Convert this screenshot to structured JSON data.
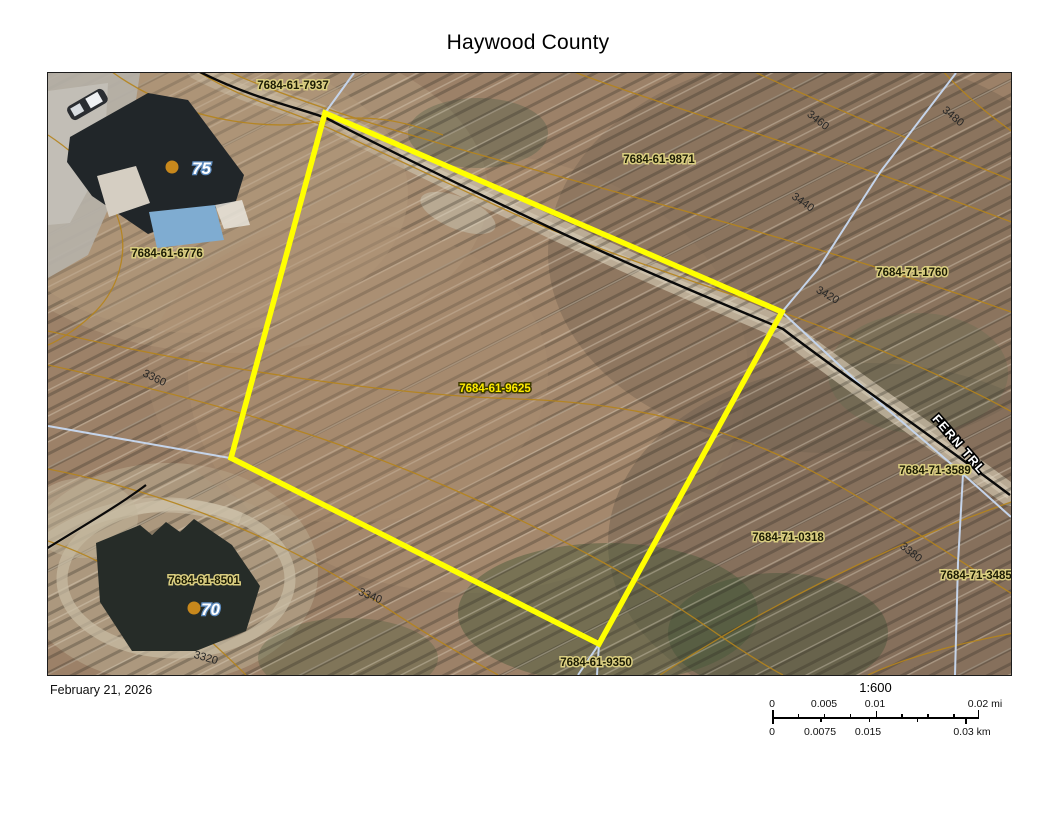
{
  "title": "Haywood County",
  "map": {
    "parcel_labels": [
      {
        "id": "7684-61-7937"
      },
      {
        "id": "7684-61-6776"
      },
      {
        "id": "7684-61-9871"
      },
      {
        "id": "7684-71-1760"
      },
      {
        "id": "7684-61-9625"
      },
      {
        "id": "7684-71-3589"
      },
      {
        "id": "7684-71-0318"
      },
      {
        "id": "7684-71-3485"
      },
      {
        "id": "7684-61-8501"
      },
      {
        "id": "7684-61-9350"
      }
    ],
    "selected_parcel": "7684-61-9625",
    "contour_labels": [
      {
        "value": "3480"
      },
      {
        "value": "3460"
      },
      {
        "value": "3440"
      },
      {
        "value": "3420"
      },
      {
        "value": "3380"
      },
      {
        "value": "3360"
      },
      {
        "value": "3340"
      },
      {
        "value": "3320"
      }
    ],
    "street_label": "FERN TRL",
    "address_markers": [
      {
        "number": "75"
      },
      {
        "number": "70"
      }
    ],
    "colors": {
      "selected_outline": "#ffff00",
      "parcel_line": "#c5d4ea",
      "contour_line": "#b5841c",
      "road_line": "#000000",
      "label_halo": "#d9cd80",
      "selected_label_text": "#ffec00",
      "address_dot": "#c8881c"
    }
  },
  "footer": {
    "date": "February 21, 2026",
    "scale_ratio": "1:600",
    "scalebar_miles": [
      "0",
      "0.005",
      "0.01",
      "0.02 mi"
    ],
    "scalebar_km": [
      "0",
      "0.0075",
      "0.015",
      "0.03 km"
    ]
  }
}
